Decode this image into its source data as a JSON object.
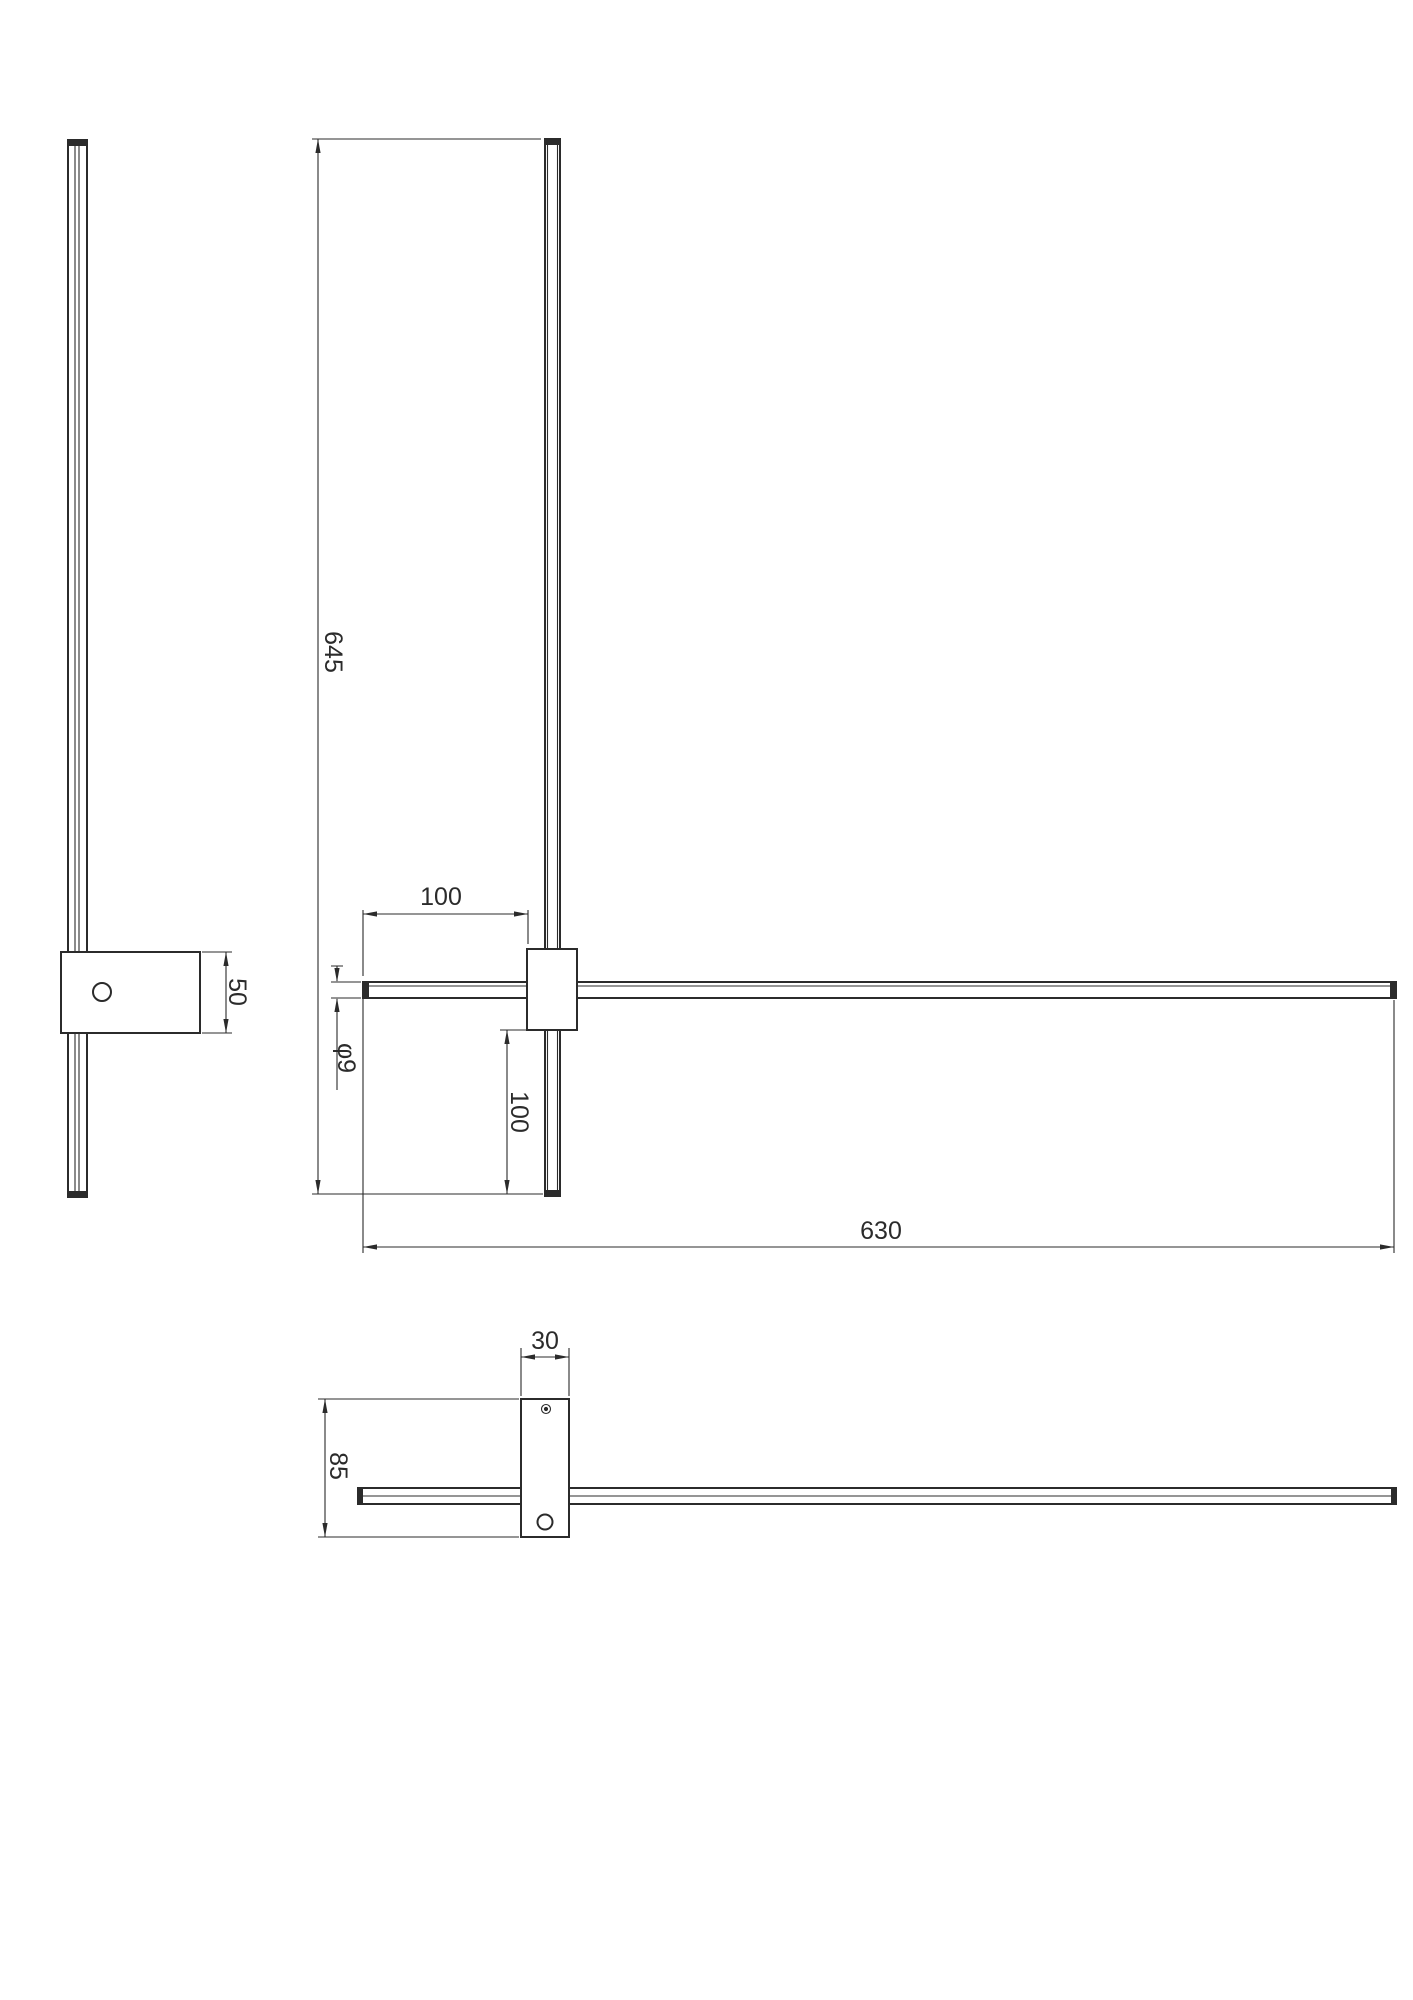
{
  "drawing": {
    "background": "#ffffff",
    "line_color": "#2b2b2b",
    "views": {
      "side": {
        "title": "side-view",
        "dims": {
          "bracket_height_mm": "50"
        }
      },
      "front": {
        "title": "front-view",
        "dims": {
          "vertical_bar_length_mm": "645",
          "left_overhang_mm": "100",
          "bar_diameter": "φ9",
          "bottom_overhang_mm": "100",
          "horizontal_bar_length_mm": "630"
        }
      },
      "top": {
        "title": "top-view",
        "dims": {
          "bracket_width_mm": "30",
          "bracket_depth_mm": "85"
        }
      }
    }
  }
}
